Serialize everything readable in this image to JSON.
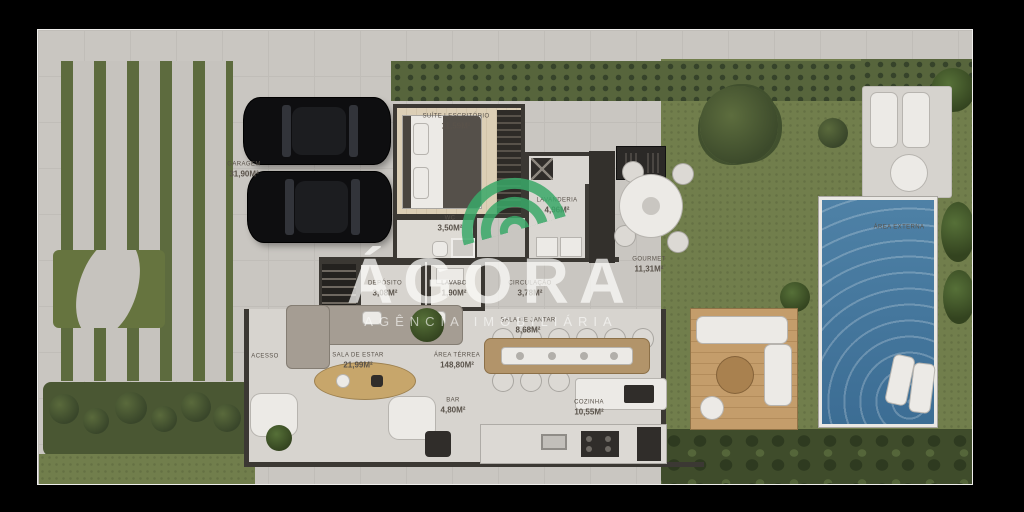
{
  "watermark": {
    "brand": "ÁGORA",
    "subtitle": "AGÊNCIA IMOBILIÁRIA"
  },
  "rooms": [
    {
      "id": "garagem",
      "label": "GARAGEM",
      "area": "31,90m²"
    },
    {
      "id": "suite",
      "label": "SUÍTE | ESCRITÓRIO",
      "area": "11,59m²"
    },
    {
      "id": "wc",
      "label": "WC",
      "area": "3,50m²"
    },
    {
      "id": "lavanderia",
      "label": "LAVANDERIA",
      "area": "4,96m²"
    },
    {
      "id": "deposito",
      "label": "DEPÓSITO",
      "area": "3,08m²"
    },
    {
      "id": "lavabo",
      "label": "LAVABO",
      "area": "1,90m²"
    },
    {
      "id": "circulacao",
      "label": "CIRCULAÇÃO",
      "area": "3,78m²"
    },
    {
      "id": "sala-jantar",
      "label": "SALA DE JANTAR",
      "area": "8,68m²"
    },
    {
      "id": "gourmet",
      "label": "GOURMET",
      "area": "11,31m²"
    },
    {
      "id": "acesso",
      "label": "ACESSO",
      "area": ""
    },
    {
      "id": "sala-estar",
      "label": "SALA DE ESTAR",
      "area": "21,99m²"
    },
    {
      "id": "area-terrea",
      "label": "ÁREA TÉRREA",
      "area": "148,80m²"
    },
    {
      "id": "bar",
      "label": "BAR",
      "area": "4,80m²"
    },
    {
      "id": "cozinha",
      "label": "COZINHA",
      "area": "10,55m²"
    },
    {
      "id": "area-externa",
      "label": "ÁREA EXTERNA",
      "area": ""
    }
  ],
  "colors": {
    "background": "#000000",
    "pavement": "#c9c6c1",
    "lawn": "#717e4c",
    "hedge": "#57653c",
    "pool_water": "#4b7da3",
    "wood_deck": "#c49d6b",
    "walls": "#3b3833",
    "logo_green": "#3aa869",
    "label_text": "#59524a",
    "watermark_text": "#fcfcfa"
  }
}
